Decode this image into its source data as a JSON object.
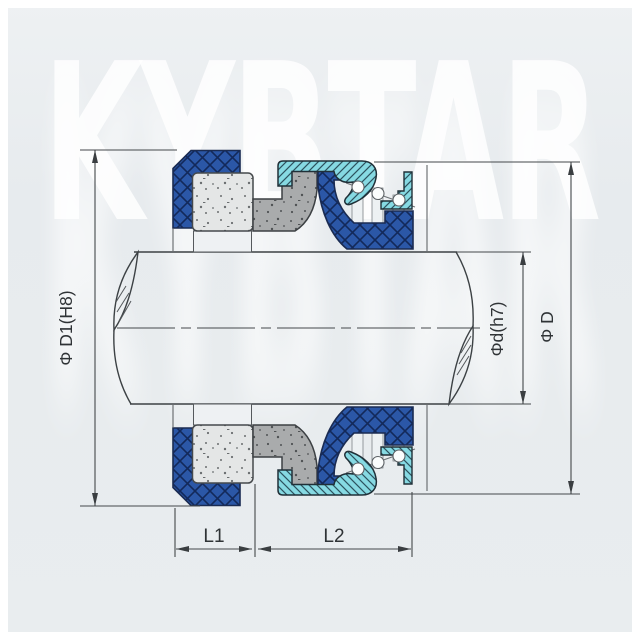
{
  "watermark": {
    "text": "KYBTAR"
  },
  "drawing": {
    "type": "mechanical-seal-cross-section",
    "dimension_labels": {
      "bore": "Φ D1(H8)",
      "shaft": "Φd(h7)",
      "outer": "Φ D",
      "length1": "L1",
      "length2": "L2"
    },
    "colors": {
      "background": "#e9edef",
      "watermark": "#ffffff",
      "elastomer_blue": "#2b57a7",
      "elastomer_hatch": "#13295a",
      "metal_cyan": "#86d9e2",
      "metal_hatch": "#2c525e",
      "seal_face_gray": "#a9abac",
      "seat_light": "#e4e6e6",
      "line": "#44484b"
    }
  }
}
